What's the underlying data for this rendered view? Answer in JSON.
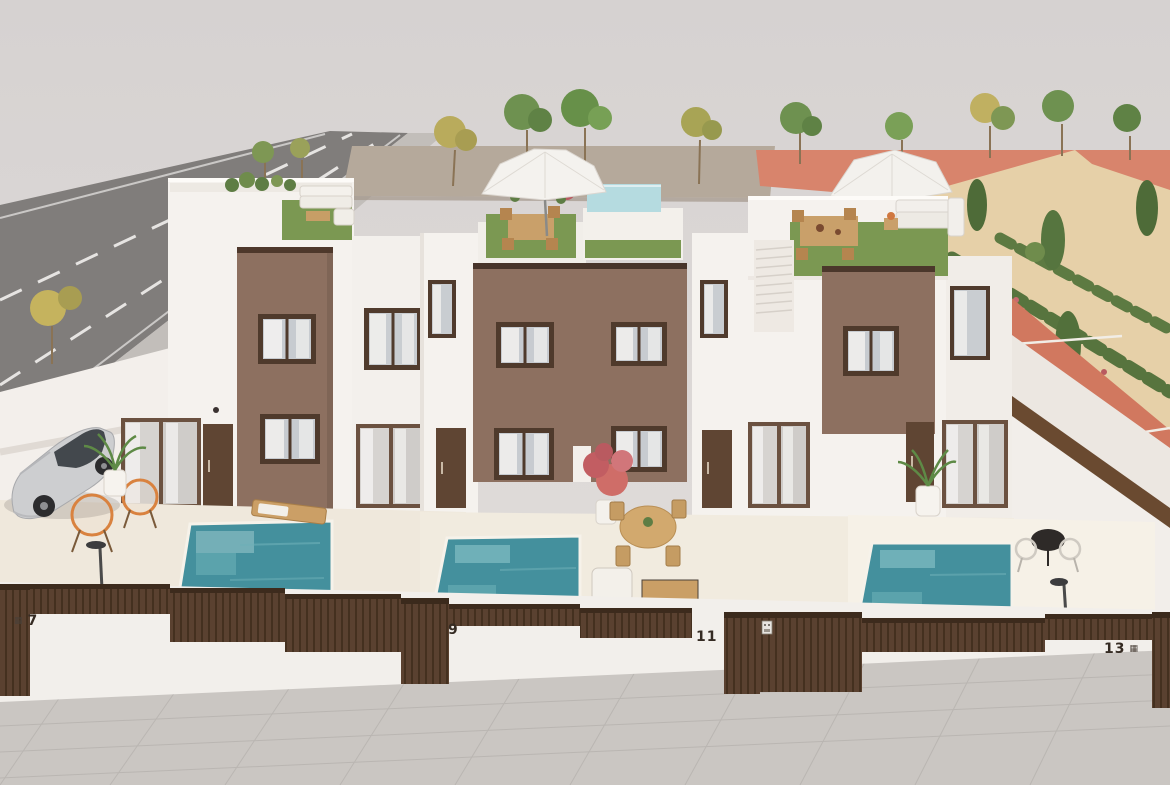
{
  "scene": {
    "description": "Aerial front view render of a row of modern white townhouses with brown accent facades, private plunge pools, rooftop terraces with furniture and a roof pool, a parked silver car, a street on the left, tiled sidewalk in front, and a landscaped garden with red track on the right."
  },
  "houses": [
    {
      "id": "house-7",
      "number": "7"
    },
    {
      "id": "house-9",
      "number": "9"
    },
    {
      "id": "house-11",
      "number": "11"
    },
    {
      "id": "house-13",
      "number": "13"
    }
  ],
  "icons": {
    "house_7_plate": "▦",
    "house_13_plate": "▦"
  },
  "colors": {
    "sky": "#dad6d4",
    "wall_white": "#f5f2ee",
    "facade_brown": "#8d7060",
    "fence_brown": "#5a4130",
    "pool_teal": "#44909d",
    "rooftop_pool": "#b5dbe0",
    "grass_green": "#7b9852",
    "sand": "#e6d0a8",
    "track_red": "#d1785f",
    "road_gray": "#807d7b",
    "sidewalk_gray": "#cac6c2",
    "terrace_cream": "#f0e9dd",
    "chair_orange": "#d9823f"
  }
}
